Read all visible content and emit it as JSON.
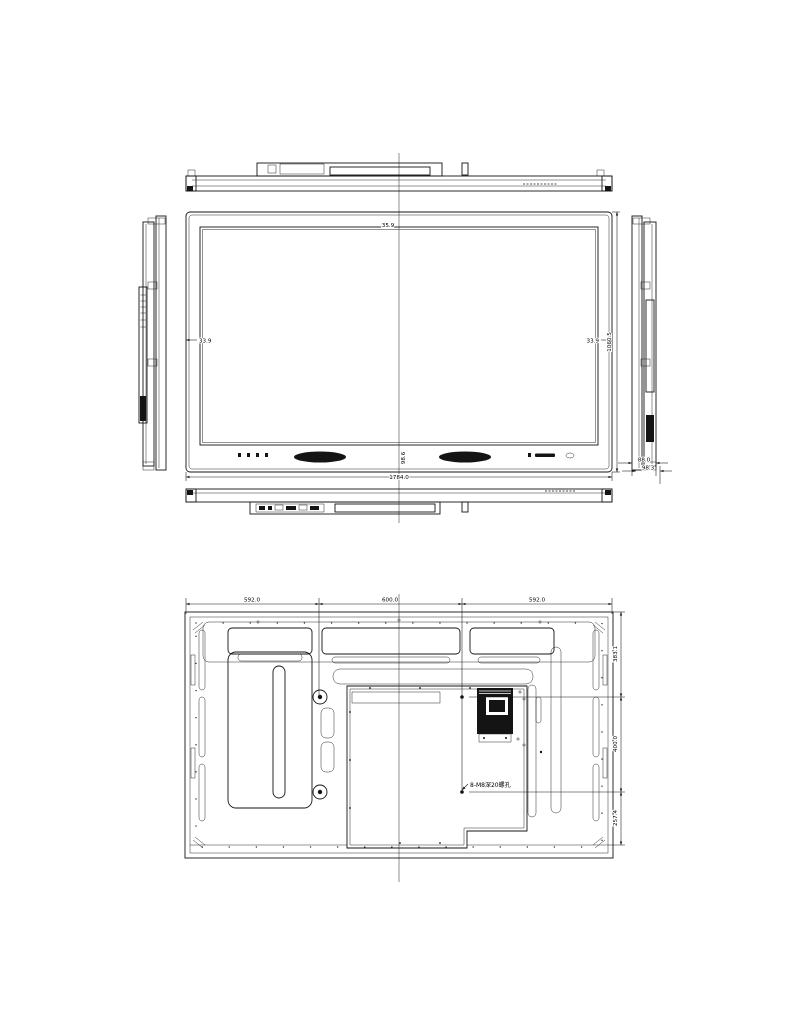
{
  "dimensions": {
    "top_bezel": "35.9",
    "left_bezel": "33.9",
    "right_bezel": "33.9",
    "overall_width": "1784.0",
    "overall_height": "1060.5",
    "bottom_bezel": "98.6",
    "depth_panel": "88.0",
    "depth_overall": "98.3",
    "rear_left_offset": "592.0",
    "rear_vesa_width": "600.0",
    "rear_right_offset": "592.0",
    "rear_top_offset": "383.1",
    "rear_vesa_height": "400.0",
    "rear_bottom_offset": "257.4",
    "mount_hole_note": "8-M8深20螺孔"
  }
}
